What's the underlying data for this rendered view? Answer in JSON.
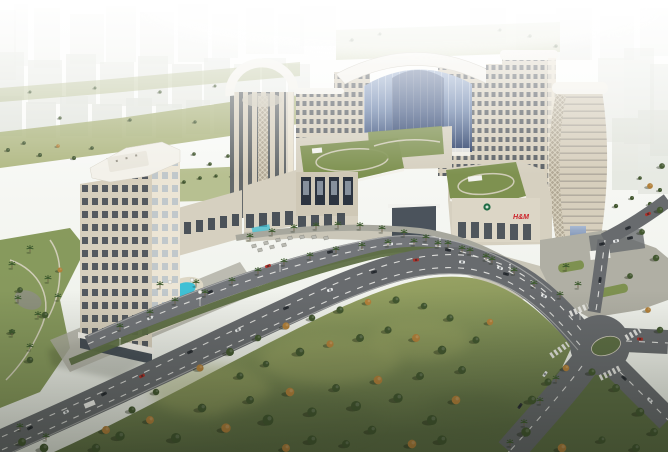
{
  "alt": "Aerial dusk rendering of a mixed-use residential complex: central arched glass atrium flanked by towers, podium mall with rooftop gardens and banner posters, standalone tower with pool, boulevard with palm medians, large tree-dotted park and road intersection",
  "scene": {
    "signage": {
      "hm": "H&M"
    },
    "bg_buildings": [
      [
        0,
        10,
        16,
        70,
        0.45
      ],
      [
        14,
        4,
        14,
        62,
        0.4
      ],
      [
        34,
        8,
        26,
        60,
        0.42
      ],
      [
        70,
        14,
        34,
        50,
        0.45
      ],
      [
        106,
        6,
        30,
        56,
        0.42
      ],
      [
        140,
        12,
        34,
        52,
        0.45
      ],
      [
        178,
        4,
        30,
        58,
        0.4
      ],
      [
        212,
        14,
        26,
        44,
        0.35
      ],
      [
        246,
        8,
        28,
        46,
        0.32
      ],
      [
        278,
        14,
        26,
        40,
        0.3
      ],
      [
        0,
        52,
        24,
        48,
        0.75
      ],
      [
        28,
        60,
        34,
        44,
        0.7
      ],
      [
        66,
        54,
        30,
        50,
        0.75
      ],
      [
        100,
        62,
        34,
        44,
        0.7
      ],
      [
        138,
        56,
        30,
        50,
        0.75
      ],
      [
        172,
        64,
        30,
        44,
        0.7
      ],
      [
        204,
        58,
        26,
        46,
        0.65
      ],
      [
        234,
        64,
        26,
        40,
        0.6
      ],
      [
        262,
        58,
        24,
        42,
        0.55
      ],
      [
        288,
        64,
        22,
        36,
        0.5
      ],
      [
        0,
        96,
        22,
        40,
        0.9
      ],
      [
        26,
        102,
        30,
        36,
        0.85
      ],
      [
        60,
        96,
        28,
        40,
        0.9
      ],
      [
        92,
        104,
        30,
        34,
        0.85
      ],
      [
        126,
        98,
        26,
        38,
        0.9
      ],
      [
        156,
        104,
        26,
        34,
        0.8
      ],
      [
        186,
        100,
        24,
        34,
        0.75
      ],
      [
        214,
        104,
        22,
        30,
        0.7
      ],
      [
        300,
        6,
        36,
        40,
        0.3
      ],
      [
        340,
        10,
        40,
        34,
        0.25
      ],
      [
        470,
        8,
        36,
        36,
        0.3
      ],
      [
        516,
        14,
        40,
        40,
        0.32
      ],
      [
        556,
        8,
        36,
        52,
        0.38
      ],
      [
        560,
        20,
        30,
        40,
        0.3
      ],
      [
        600,
        16,
        34,
        44,
        0.3
      ],
      [
        640,
        8,
        28,
        48,
        0.35
      ],
      [
        598,
        58,
        26,
        84,
        0.5
      ],
      [
        624,
        48,
        30,
        96,
        0.55
      ],
      [
        650,
        64,
        18,
        92,
        0.6
      ],
      [
        612,
        118,
        26,
        72,
        0.7
      ],
      [
        638,
        110,
        30,
        84,
        0.65
      ],
      [
        568,
        120,
        20,
        60,
        0.5
      ]
    ],
    "bg_trees": [
      [
        8,
        150,
        0.55
      ],
      [
        24,
        143,
        0.5
      ],
      [
        40,
        155,
        0.55
      ],
      [
        58,
        146,
        0.5,
        "a"
      ],
      [
        74,
        158,
        0.55
      ],
      [
        92,
        148,
        0.5
      ],
      [
        108,
        160,
        0.55
      ],
      [
        126,
        150,
        0.5
      ],
      [
        142,
        162,
        0.55,
        "a"
      ],
      [
        158,
        152,
        0.5
      ],
      [
        176,
        163,
        0.55
      ],
      [
        194,
        154,
        0.5
      ],
      [
        210,
        164,
        0.5
      ],
      [
        228,
        156,
        0.5
      ],
      [
        246,
        148,
        0.5
      ],
      [
        262,
        142,
        0.45,
        "a"
      ],
      [
        280,
        136,
        0.5
      ],
      [
        300,
        128,
        0.45
      ],
      [
        318,
        122,
        0.45
      ],
      [
        30,
        92,
        0.4
      ],
      [
        95,
        88,
        0.4
      ],
      [
        160,
        92,
        0.45
      ],
      [
        215,
        86,
        0.4
      ],
      [
        250,
        96,
        0.4,
        "a"
      ],
      [
        60,
        118,
        0.45
      ],
      [
        130,
        120,
        0.45
      ],
      [
        195,
        122,
        0.45
      ],
      [
        245,
        124,
        0.4
      ],
      [
        285,
        114,
        0.4
      ],
      [
        320,
        106,
        0.4
      ],
      [
        352,
        40,
        0.45
      ],
      [
        380,
        34,
        0.4
      ],
      [
        500,
        30,
        0.4
      ],
      [
        530,
        36,
        0.45
      ],
      [
        556,
        46,
        0.45
      ],
      [
        602,
        200,
        0.55
      ],
      [
        616,
        206,
        0.6
      ],
      [
        632,
        198,
        0.55
      ],
      [
        650,
        204,
        0.6
      ],
      [
        640,
        178,
        0.5
      ],
      [
        660,
        190,
        0.55
      ],
      [
        316,
        152,
        0.45
      ],
      [
        336,
        146,
        0.4
      ],
      [
        366,
        142,
        0.45
      ],
      [
        388,
        150,
        0.4
      ],
      [
        344,
        170,
        0.45
      ],
      [
        374,
        168,
        0.4
      ],
      [
        380,
        140,
        0.45
      ],
      [
        396,
        136,
        0.45
      ],
      [
        412,
        134,
        0.45
      ],
      [
        428,
        132,
        0.4
      ],
      [
        388,
        152,
        0.4
      ],
      [
        420,
        148,
        0.4
      ],
      [
        458,
        180,
        0.45
      ],
      [
        476,
        170,
        0.4
      ],
      [
        500,
        168,
        0.45
      ],
      [
        512,
        186,
        0.4
      ],
      [
        470,
        194,
        0.45
      ],
      [
        220,
        290,
        0.5
      ],
      [
        246,
        278,
        0.5
      ],
      [
        300,
        262,
        0.5
      ],
      [
        352,
        250,
        0.5
      ],
      [
        400,
        246,
        0.5
      ],
      [
        450,
        250,
        0.5
      ],
      [
        608,
        344,
        0.5
      ],
      [
        616,
        348,
        0.45
      ],
      [
        566,
        264,
        0.45
      ],
      [
        604,
        288,
        0.45
      ],
      [
        618,
        292,
        0.4
      ],
      [
        168,
        186,
        0.5
      ],
      [
        184,
        182,
        0.5
      ],
      [
        200,
        178,
        0.5
      ],
      [
        216,
        176,
        0.45
      ],
      [
        232,
        176,
        0.45
      ]
    ],
    "trees": [
      [
        120,
        436,
        1.3
      ],
      [
        150,
        420,
        1.1,
        "a"
      ],
      [
        176,
        438,
        1.4
      ],
      [
        202,
        408,
        1.2
      ],
      [
        226,
        428,
        1.3,
        "a"
      ],
      [
        250,
        400,
        1.1
      ],
      [
        268,
        420,
        1.5
      ],
      [
        290,
        392,
        1.2,
        "a"
      ],
      [
        312,
        412,
        1.3
      ],
      [
        336,
        388,
        1.1
      ],
      [
        356,
        406,
        1.4
      ],
      [
        378,
        380,
        1.2,
        "a"
      ],
      [
        398,
        398,
        1.3
      ],
      [
        420,
        376,
        1.1
      ],
      [
        200,
        368,
        1.0,
        "a"
      ],
      [
        230,
        352,
        1.1
      ],
      [
        258,
        338,
        0.9
      ],
      [
        286,
        326,
        1.0,
        "a"
      ],
      [
        312,
        318,
        0.9
      ],
      [
        340,
        310,
        1.0
      ],
      [
        368,
        302,
        0.9,
        "a"
      ],
      [
        396,
        300,
        1.0
      ],
      [
        424,
        306,
        0.9
      ],
      [
        450,
        318,
        1.0
      ],
      [
        300,
        352,
        1.2
      ],
      [
        330,
        344,
        1.0,
        "a"
      ],
      [
        360,
        338,
        1.1
      ],
      [
        388,
        330,
        1.0
      ],
      [
        416,
        338,
        1.1,
        "a"
      ],
      [
        442,
        350,
        1.2
      ],
      [
        462,
        370,
        1.1
      ],
      [
        432,
        420,
        1.4
      ],
      [
        456,
        400,
        1.2,
        "a"
      ],
      [
        156,
        392,
        0.9
      ],
      [
        132,
        410,
        1.0
      ],
      [
        106,
        430,
        1.1,
        "a"
      ],
      [
        96,
        448,
        1.2
      ],
      [
        476,
        340,
        1.0
      ],
      [
        490,
        322,
        0.9,
        "a"
      ],
      [
        240,
        376,
        1.0
      ],
      [
        266,
        364,
        0.9
      ],
      [
        442,
        440,
        1.3
      ],
      [
        412,
        444,
        1.2,
        "a"
      ],
      [
        372,
        430,
        1.2
      ],
      [
        346,
        444,
        1.1
      ],
      [
        312,
        440,
        1.3
      ],
      [
        286,
        448,
        1.1,
        "a"
      ],
      [
        22,
        442,
        1.1
      ],
      [
        44,
        448,
        1.2
      ],
      [
        532,
        400,
        1.2
      ],
      [
        548,
        382,
        1.0
      ],
      [
        566,
        368,
        0.9,
        "a"
      ],
      [
        592,
        372,
        1.0
      ],
      [
        616,
        388,
        1.1
      ],
      [
        640,
        412,
        1.2
      ],
      [
        654,
        432,
        1.1
      ],
      [
        526,
        432,
        1.3
      ],
      [
        562,
        448,
        1.2,
        "a"
      ],
      [
        602,
        440,
        1.0
      ],
      [
        636,
        448,
        1.1
      ],
      [
        660,
        330,
        0.9
      ],
      [
        648,
        310,
        0.8,
        "a"
      ],
      [
        630,
        276,
        0.8
      ],
      [
        656,
        258,
        0.9
      ],
      [
        642,
        232,
        0.8
      ],
      [
        660,
        210,
        0.9
      ],
      [
        650,
        186,
        0.8,
        "a"
      ],
      [
        662,
        166,
        0.8
      ],
      [
        20,
        290,
        0.8
      ],
      [
        45,
        315,
        0.9
      ],
      [
        60,
        270,
        0.7,
        "a"
      ],
      [
        30,
        360,
        0.9
      ],
      [
        12,
        332,
        0.8
      ]
    ],
    "palms": [
      [
        205,
        296
      ],
      [
        232,
        284
      ],
      [
        258,
        274
      ],
      [
        284,
        265
      ],
      [
        310,
        259
      ],
      [
        336,
        253
      ],
      [
        362,
        249
      ],
      [
        388,
        246
      ],
      [
        414,
        245
      ],
      [
        438,
        247
      ],
      [
        462,
        252
      ],
      [
        486,
        260
      ],
      [
        250,
        240
      ],
      [
        272,
        235
      ],
      [
        294,
        231
      ],
      [
        316,
        229
      ],
      [
        338,
        228
      ],
      [
        360,
        229
      ],
      [
        382,
        232
      ],
      [
        404,
        236
      ],
      [
        426,
        241
      ],
      [
        448,
        247
      ],
      [
        470,
        254
      ],
      [
        492,
        263
      ],
      [
        514,
        274
      ],
      [
        534,
        287
      ],
      [
        120,
        330
      ],
      [
        150,
        316
      ],
      [
        175,
        304
      ],
      [
        160,
        288
      ],
      [
        196,
        286
      ],
      [
        12,
        268
      ],
      [
        30,
        252
      ],
      [
        48,
        282
      ],
      [
        18,
        302
      ],
      [
        38,
        318
      ],
      [
        58,
        300
      ],
      [
        12,
        336
      ],
      [
        30,
        350
      ],
      [
        556,
        382
      ],
      [
        540,
        404
      ],
      [
        524,
        426
      ],
      [
        510,
        446
      ],
      [
        560,
        298
      ],
      [
        578,
        288
      ],
      [
        566,
        270
      ],
      [
        46,
        440
      ],
      [
        20,
        430
      ]
    ],
    "cars": [
      [
        30,
        428,
        -26,
        "d"
      ],
      [
        66,
        412,
        -26,
        "w"
      ],
      [
        104,
        394,
        -27,
        "d"
      ],
      [
        142,
        376,
        -26,
        "r"
      ],
      [
        190,
        352,
        -24,
        "d"
      ],
      [
        238,
        330,
        -23,
        "w"
      ],
      [
        286,
        308,
        -22,
        "d"
      ],
      [
        330,
        290,
        -18,
        "w"
      ],
      [
        374,
        272,
        -14,
        "d"
      ],
      [
        416,
        260,
        -6,
        "r"
      ],
      [
        462,
        262,
        4,
        "w"
      ],
      [
        506,
        274,
        14,
        "d"
      ],
      [
        544,
        296,
        24,
        "w"
      ],
      [
        150,
        318,
        -24,
        "w"
      ],
      [
        210,
        292,
        -22,
        "d"
      ],
      [
        268,
        266,
        -20,
        "r"
      ],
      [
        330,
        252,
        -12,
        "d"
      ],
      [
        390,
        244,
        -4,
        "w"
      ],
      [
        448,
        250,
        10,
        "d"
      ],
      [
        500,
        268,
        20,
        "w"
      ],
      [
        545,
        374,
        126,
        "w"
      ],
      [
        520,
        406,
        126,
        "d"
      ],
      [
        640,
        339,
        2,
        "r"
      ],
      [
        600,
        280,
        -82,
        "d"
      ],
      [
        648,
        214,
        -24,
        "r"
      ],
      [
        628,
        228,
        -24,
        "d"
      ],
      [
        624,
        378,
        42,
        "d"
      ],
      [
        650,
        400,
        42,
        "w"
      ],
      [
        602,
        244,
        -12,
        "d"
      ],
      [
        616,
        241,
        -12,
        "w"
      ],
      [
        630,
        238,
        -12,
        "d"
      ]
    ],
    "lights": [
      [
        120,
        346
      ],
      [
        200,
        306
      ],
      [
        280,
        272
      ],
      [
        360,
        250
      ],
      [
        440,
        246
      ],
      [
        510,
        272
      ],
      [
        580,
        320
      ]
    ],
    "umbrellas": [
      [
        254,
        246
      ],
      [
        266,
        243
      ],
      [
        278,
        240
      ],
      [
        290,
        238
      ],
      [
        302,
        237
      ],
      [
        314,
        237
      ],
      [
        326,
        238
      ],
      [
        260,
        250
      ],
      [
        272,
        247
      ],
      [
        284,
        245
      ]
    ],
    "pool_umbrellas": [
      [
        170,
        282
      ],
      [
        192,
        280
      ],
      [
        200,
        292
      ]
    ],
    "banners": [
      301,
      315,
      329,
      343
    ]
  },
  "colors": {
    "sky_top": "#ffffff",
    "sky_low": "#e9ece3",
    "bg_building": "#dfe2da",
    "greenery_bg": "#a8b178",
    "facade_light": "#ece5d5",
    "facade_mid": "#d7cfbd",
    "facade_shadow": "#b3aa97",
    "window_glass": "#38414b",
    "atrium_blue_light": "#a3b6d4",
    "atrium_blue": "#6d84ab",
    "atrium_blue_dark": "#31446b",
    "roof_white": "#f3f1ea",
    "podium_wall": "#d6d0c0",
    "garden_green": "#7e9150",
    "garden_path": "#d8d3c2",
    "road": "#686b6e",
    "road_light": "#73767a",
    "lane": "#e9e9e5",
    "sidewalk": "#a7a79d",
    "lawn_light": "#a3ab68",
    "lawn": "#84935a",
    "lawn_dark": "#5e6f45",
    "tree_green": "#42572f",
    "tree_autumn": "#b2803a",
    "palm_green": "#3d5a2e",
    "pool": "#3fc0d5",
    "hm_red": "#cc2229",
    "logo_green": "#1f6b44",
    "banner_dark": "#2c3440",
    "car_dark": "#2e3237",
    "car_white": "#e8eaea",
    "car_red": "#b03028",
    "canopy_white": "#f2f2ee"
  }
}
